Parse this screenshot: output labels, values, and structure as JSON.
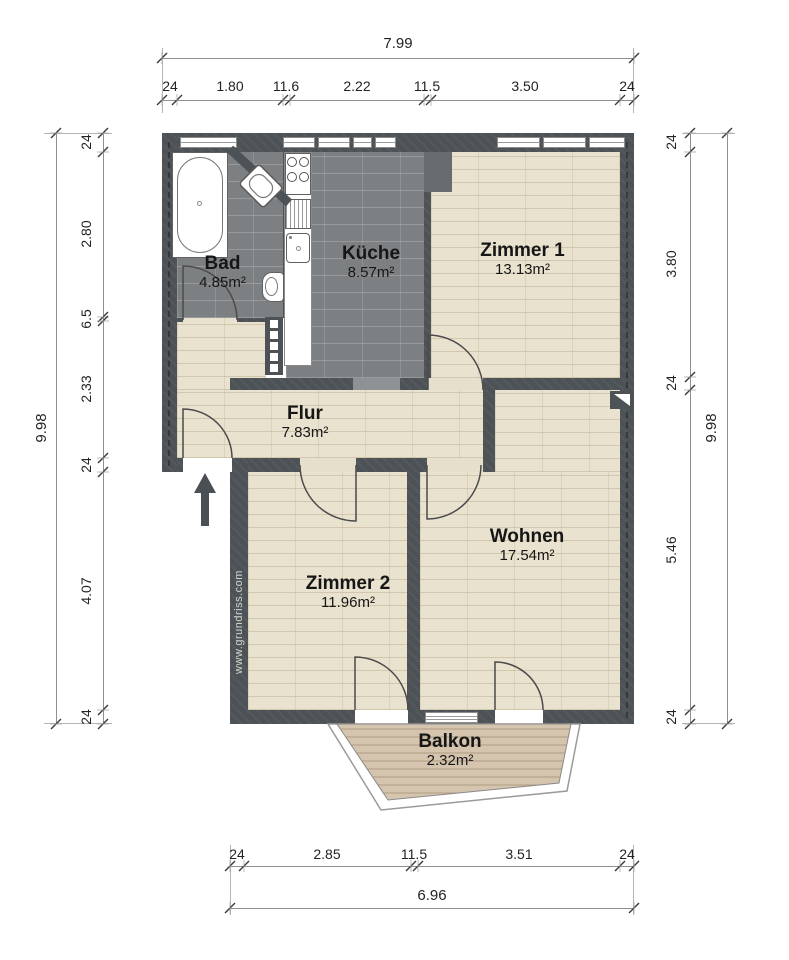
{
  "watermark": "www.grundriss.com",
  "rooms": {
    "bad": {
      "name": "Bad",
      "area": "4.85m²"
    },
    "kueche": {
      "name": "Küche",
      "area": "8.57m²"
    },
    "zimmer1": {
      "name": "Zimmer 1",
      "area": "13.13m²"
    },
    "flur": {
      "name": "Flur",
      "area": "7.83m²"
    },
    "zimmer2": {
      "name": "Zimmer 2",
      "area": "11.96m²"
    },
    "wohnen": {
      "name": "Wohnen",
      "area": "17.54m²"
    },
    "balkon": {
      "name": "Balkon",
      "area": "2.32m²"
    }
  },
  "dimensions": {
    "top": {
      "total": "7.99",
      "segments": [
        "24",
        "1.80",
        "11.6",
        "2.22",
        "11.5",
        "3.50",
        "24"
      ]
    },
    "bottom": {
      "total": "6.96",
      "segments": [
        "24",
        "2.85",
        "11.5",
        "3.51",
        "24"
      ]
    },
    "left": {
      "total": "9.98",
      "segments": [
        "24",
        "2.80",
        "6.5",
        "2.33",
        "24",
        "4.07",
        "24"
      ]
    },
    "right": {
      "total": "9.98",
      "segments": [
        "24",
        "3.80",
        "24",
        "5.46",
        "24"
      ]
    }
  },
  "icons": {
    "bathtub": "bathtub-icon",
    "corner_washbasin": "washbasin-icon",
    "toilet": "toilet-icon",
    "stove": "stove-icon",
    "drainboard": "drainboard-icon",
    "sink": "sink-icon",
    "radiator": "radiator-icon",
    "entrance_arrow": "entrance-arrow-icon",
    "chimney": "chimney-icon"
  },
  "colors": {
    "wall": "#4d5256",
    "tile_floor": "#7d8082",
    "wood_floor": "#e9e2cf",
    "balcony_deck": "#d6c5ae",
    "dimension_text": "#222222"
  }
}
